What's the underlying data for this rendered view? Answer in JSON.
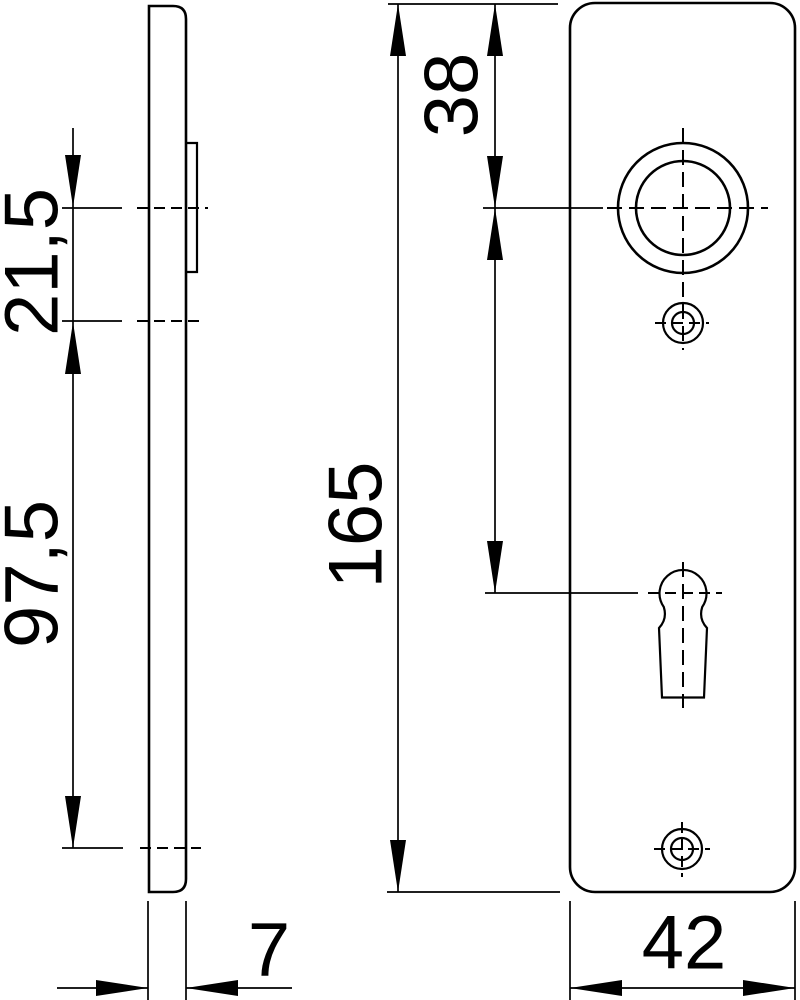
{
  "drawing": {
    "title": "door-plate-dimension-drawing",
    "views": {
      "side_view": "plate-side-profile",
      "front_view": "plate-front-face"
    },
    "dimensions": {
      "handle_to_top_screw": "21,5",
      "screw_spacing": "97,5",
      "plate_thickness": "7",
      "top_to_handle": "38",
      "plate_height": "165",
      "plate_width": "42"
    },
    "features": {
      "handle_hole": "handle-bore-with-collar",
      "keyhole": "bb-keyhole",
      "screw_top": "screw-hole",
      "screw_bottom": "screw-hole"
    }
  },
  "colors": {
    "line": "#000000",
    "background": "#ffffff",
    "text": "#000000"
  }
}
